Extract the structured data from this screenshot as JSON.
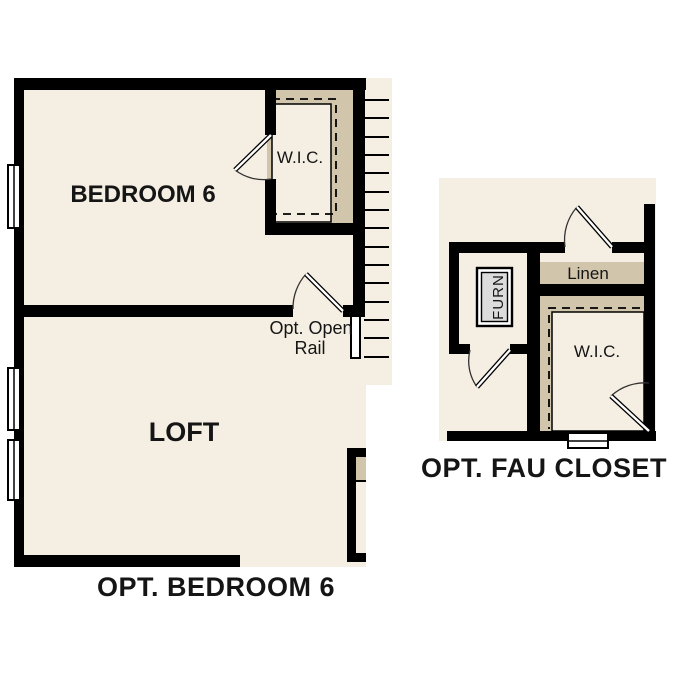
{
  "figure": {
    "type": "floor-plan-options",
    "plans": [
      {
        "id": "opt-bedroom-6",
        "title": "OPT. BEDROOM 6",
        "labels": {
          "bedroom": "BEDROOM 6",
          "loft": "LOFT",
          "closet": "W.I.C.",
          "rail_note_line1": "Opt. Open",
          "rail_note_line2": "Rail"
        }
      },
      {
        "id": "opt-fau-closet",
        "title": "OPT. FAU CLOSET",
        "labels": {
          "linen": "Linen",
          "closet": "W.I.C.",
          "furnace": "FURN"
        }
      }
    ]
  },
  "colors": {
    "background": "#ffffff",
    "floor": "#f5efe3",
    "closet_shading": "#d1c5ac",
    "wall": "#000000",
    "furnace_fill": "#dcdcdc",
    "text": "#151515"
  }
}
